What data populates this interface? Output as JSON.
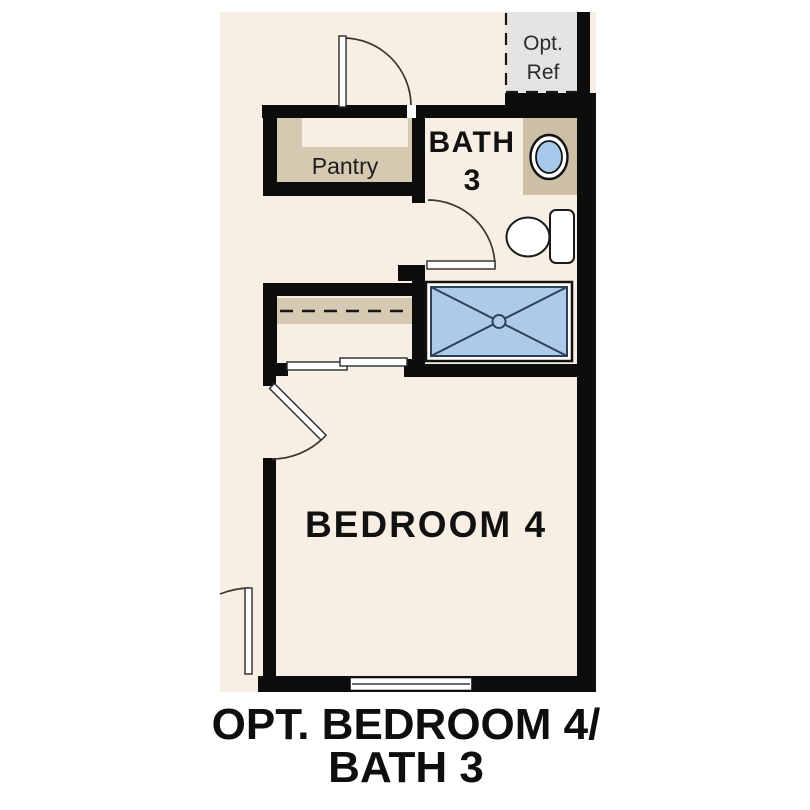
{
  "plan": {
    "labels": {
      "opt_ref": {
        "line1": "Opt.",
        "line2": "Ref"
      },
      "pantry": "Pantry",
      "bath": {
        "line1": "BATH",
        "line2": "3"
      },
      "bedroom": "BEDROOM 4"
    },
    "title": {
      "line1": "OPT. BEDROOM 4/",
      "line2": "BATH 3"
    },
    "fixtures": {
      "refrigerator": "optional-refrigerator-area",
      "pantry_casework": "pantry-shelving",
      "closet": "closet-shelf-and-rod",
      "closet_doors": "bypass-sliding-doors",
      "sink": "bathroom-sink",
      "toilet": "toilet",
      "shower": "walk-in-shower",
      "window": "window",
      "swing_doors": "hinged-door-swing"
    },
    "colors": {
      "background": "#ffffff",
      "floor": "#f7efe3",
      "wall": "#0d0d0d",
      "casework_tan": "#d6c9b2",
      "counter_tan": "#cdbfa6",
      "opt_ref_gray": "#e5e4e2",
      "sink_blue": "#a6c8ea",
      "shower_blue": "#adcbe9",
      "shower_line": "#2e4057"
    }
  }
}
